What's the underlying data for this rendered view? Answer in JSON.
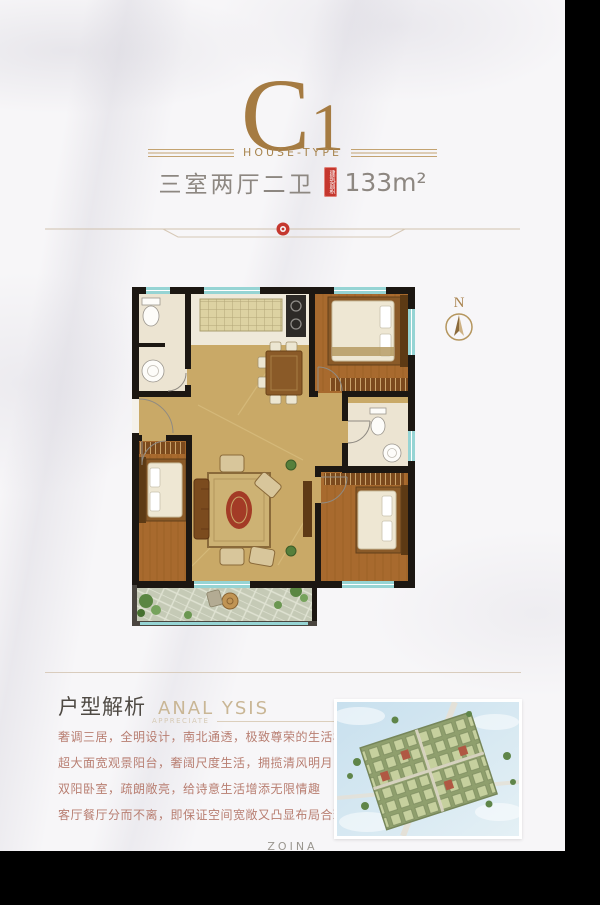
{
  "header": {
    "type_code_main": "C",
    "type_code_sub": "1",
    "type_label": "HOUSE-TYPE",
    "layout_text": "三室两厅二卫",
    "area_seal_text": "建筑面积",
    "area_value": "133m²"
  },
  "floor_plan": {
    "compass_label": "N"
  },
  "analysis": {
    "title_cn": "户型解析",
    "title_en": "ANAL YSIS",
    "subtitle_en": "APPRECIATE",
    "paragraphs": [
      "奢调三居，全明设计，南北通透，极致尊荣的生活格局",
      "超大面宽观景阳台，奢阔尺度生活，拥揽清风明月",
      "双阳卧室，疏朗敞亮，给诗意生活增添无限情趣",
      "客厅餐厅分而不离，即保证空间宽敞又凸显布局合理"
    ]
  },
  "footer": {
    "brand": "ZOINA"
  },
  "colors": {
    "title_gold": "#a57b42",
    "seal_red": "#c5372e",
    "body_text_red": "#b87e71",
    "window_teal": "#96d4d4",
    "wood_floor": "#a86a2e",
    "hall_floor_tan": "#c9a967",
    "wall_black": "#1c1712"
  }
}
